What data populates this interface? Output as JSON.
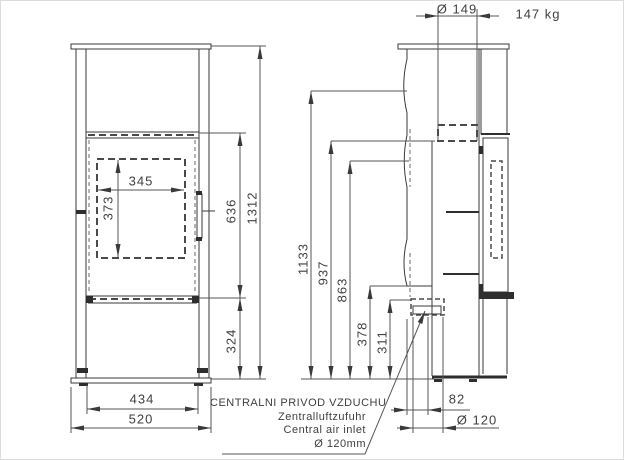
{
  "front_view": {
    "dim_firebox_opening_width": "345",
    "dim_firebox_opening_height": "373",
    "dim_door_section_height": "636",
    "dim_overall_height": "1312",
    "dim_base_section_height": "324",
    "dim_body_width": "434",
    "dim_overall_width": "520"
  },
  "side_view": {
    "dim_flue_diameter": "Ø 149",
    "weight": "147 kg",
    "dim_height_1133": "1133",
    "dim_height_937": "937",
    "dim_height_863": "863",
    "dim_inlet_top_height": "378",
    "dim_inlet_axis_height": "311",
    "dim_inlet_offset": "82",
    "dim_inlet_diameter": "Ø 120"
  },
  "air_inlet_note": {
    "line_sl": "CENTRALNI PRIVOD VZDUCHU",
    "line_de": "Zentralluftzufuhr",
    "line_en": "Central air inlet",
    "line_size": "Ø 120mm"
  }
}
